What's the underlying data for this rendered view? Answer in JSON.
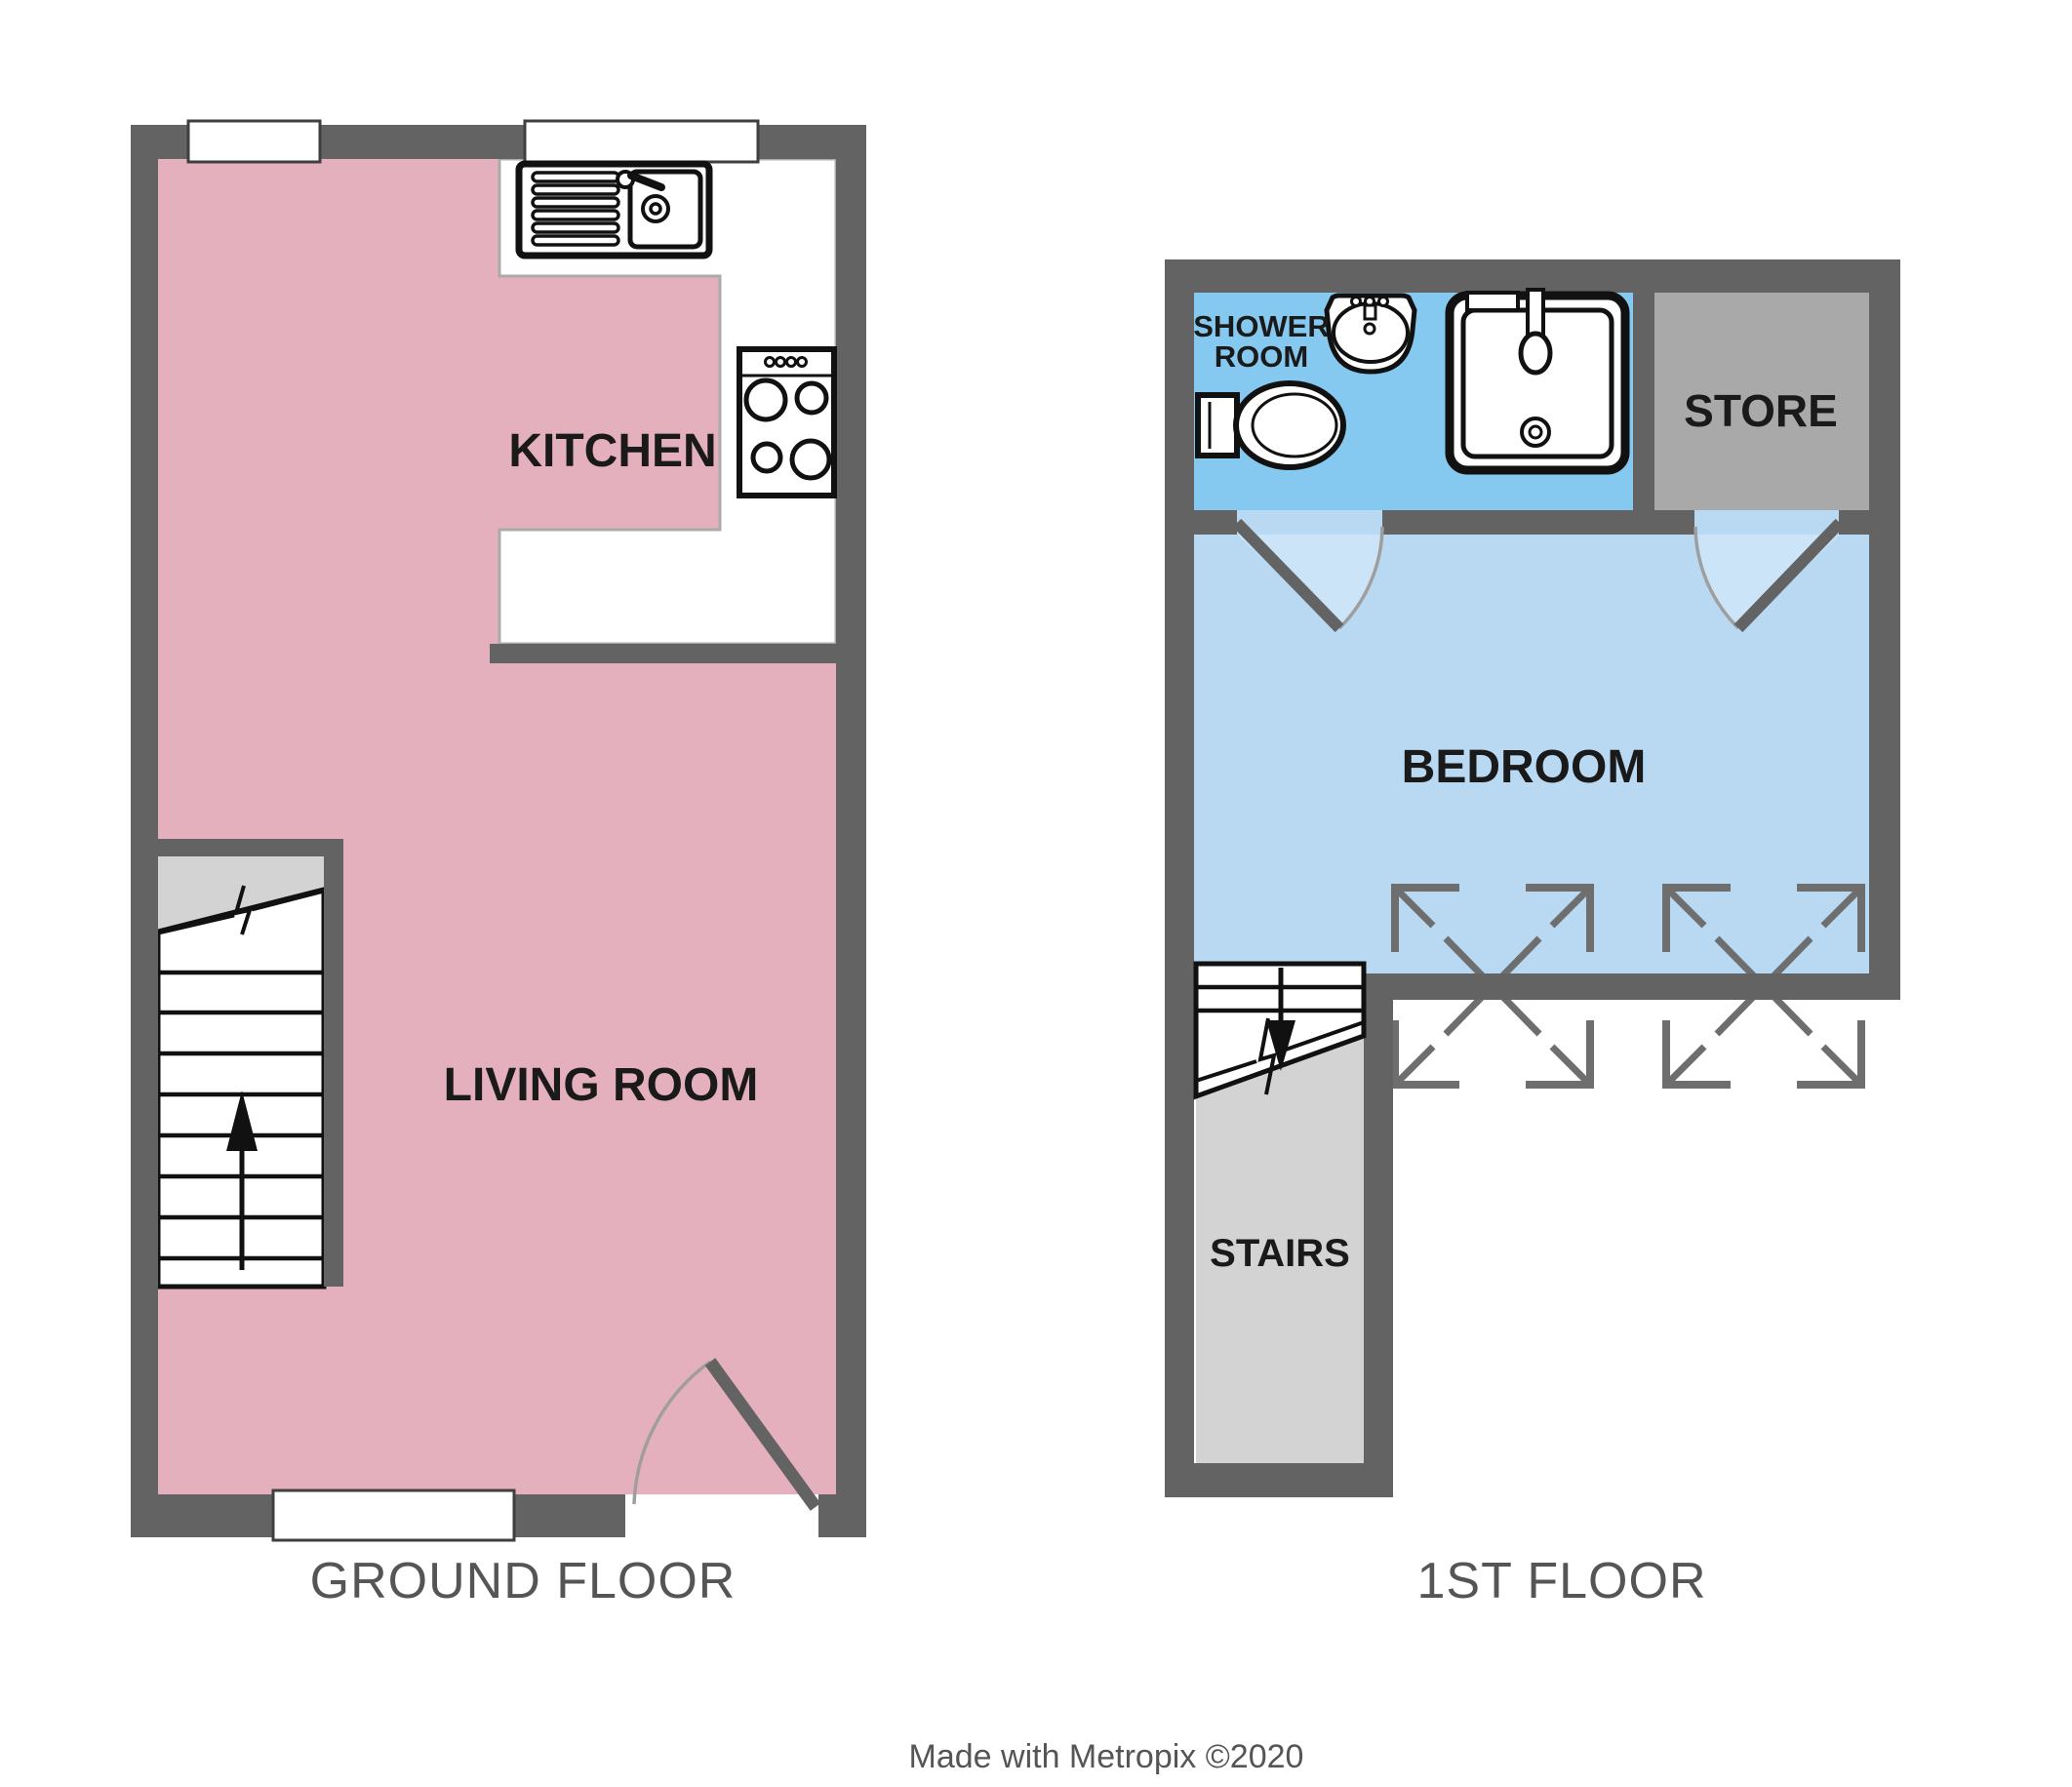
{
  "labels": {
    "kitchen": "KITCHEN",
    "living_room": "LIVING ROOM",
    "shower_room_line_1": "SHOWER",
    "shower_room_line_2": "ROOM",
    "store": "STORE",
    "bedroom": "BEDROOM",
    "stairs": "STAIRS",
    "ground_floor_title": "GROUND FLOOR",
    "first_floor_title": "1ST FLOOR",
    "credit": "Made with Metropix ©2020"
  },
  "colors": {
    "wall": "#636363",
    "kitchen_living_floor": "#E5B0BE",
    "shower_room_floor": "#85C9F0",
    "bedroom_floor": "#B9D9F2",
    "door_swing_highlight": "#CBE4F7",
    "store_floor": "#A9A9A9",
    "stairs_floor": "#D3D3D3",
    "counter_outline": "#ABABAB",
    "fixture_outline": "#111111",
    "window_frame": "#3F3F3F",
    "door_arc": "#9E9E9E",
    "roof_window_stroke": "#6E6E6E",
    "room_label_text": "#1A1A1A",
    "caption_text": "#555555"
  },
  "icons": [
    "kitchen-sink-icon",
    "stove-hob-icon",
    "stairs-up-icon",
    "stairs-down-icon",
    "door-swing-icon",
    "window-icon",
    "roof-window-icon",
    "toilet-icon",
    "basin-icon",
    "shower-cubicle-icon"
  ]
}
